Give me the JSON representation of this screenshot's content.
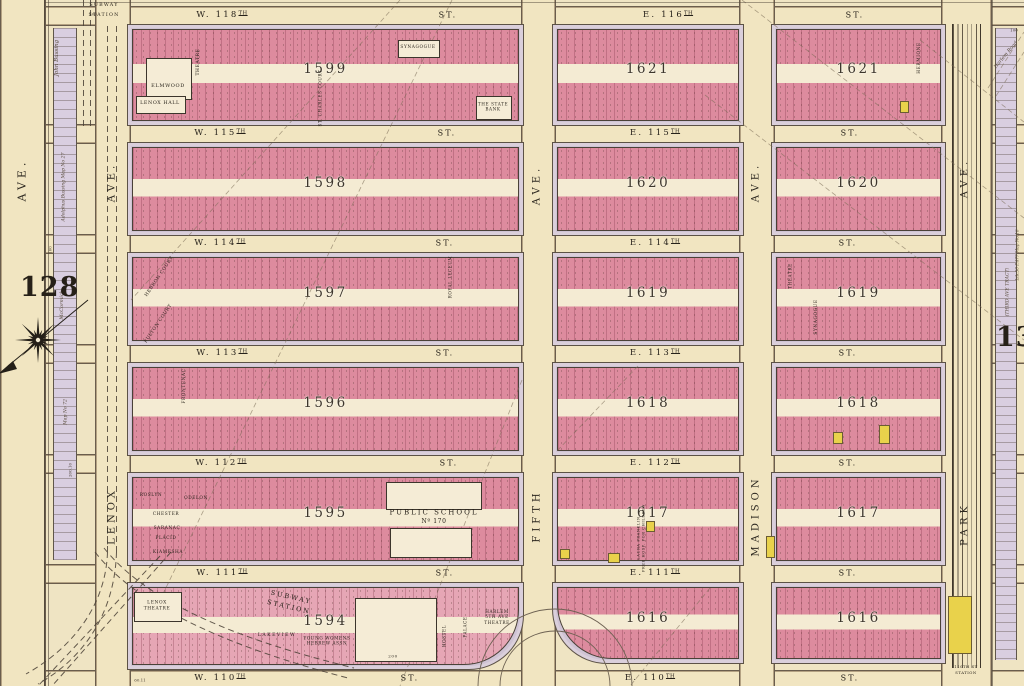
{
  "plate": {
    "left": "128",
    "right": "130"
  },
  "subway": {
    "top_line1": "SUBWAY",
    "top_line2": "STATION",
    "bottom_label": "SUBWAY\nSTATION",
    "park_station_line1": "110TH ST",
    "park_station_line2": "STATION"
  },
  "colors": {
    "paper": "#efe4c3",
    "street": "#f1e5c1",
    "block_pink": "#dd8b9e",
    "sidewalk": "#cfc3d4",
    "frame_yellow": "#e9d24b",
    "ink": "#2e2a22"
  },
  "avenues": [
    {
      "id": "west-edge-ave",
      "x": 0,
      "w": 44,
      "labels": [
        {
          "t": "AVE.",
          "cx": 22,
          "cy": 180,
          "s": 11
        }
      ]
    },
    {
      "id": "lenox-ave",
      "x": 95,
      "w": 34,
      "labels": [
        {
          "t": "AVE.",
          "cx": 112,
          "cy": 182,
          "s": 10
        },
        {
          "t": "LENOX",
          "cx": 112,
          "cy": 516,
          "s": 10
        }
      ]
    },
    {
      "id": "fifth-ave",
      "x": 521,
      "w": 33,
      "labels": [
        {
          "t": "AVE.",
          "cx": 537,
          "cy": 185,
          "s": 10
        },
        {
          "t": "FIFTH",
          "cx": 537,
          "cy": 516,
          "s": 10
        }
      ]
    },
    {
      "id": "madison-ave",
      "x": 739,
      "w": 34,
      "labels": [
        {
          "t": "AVE.",
          "cx": 756,
          "cy": 182,
          "s": 10
        },
        {
          "t": "MADISON",
          "cx": 756,
          "cy": 516,
          "s": 10
        }
      ]
    },
    {
      "id": "park-ave",
      "x": 941,
      "w": 49,
      "labels": [
        {
          "t": "AVE.",
          "cx": 965,
          "cy": 178,
          "s": 10
        },
        {
          "t": "PARK",
          "cx": 965,
          "cy": 524,
          "s": 10
        }
      ]
    }
  ],
  "streets": [
    {
      "id": "w-118th-e-116th",
      "west": "W. 118TH",
      "west_st": "ST.",
      "east": "E. 116TH",
      "east_st": "ST.",
      "y": 6,
      "h": 18,
      "wx": 222,
      "wsx": 448,
      "ex": 668,
      "esx": 855
    },
    {
      "id": "w-115th-e-115th",
      "west": "W. 115TH",
      "west_st": "ST.",
      "east": "E. 115TH",
      "east_st": "ST.",
      "y": 124,
      "h": 18,
      "wx": 220,
      "wsx": 447,
      "ex": 655,
      "esx": 850
    },
    {
      "id": "w-114th-e-114th",
      "west": "W. 114TH",
      "west_st": "ST.",
      "east": "E. 114TH",
      "east_st": "ST.",
      "y": 234,
      "h": 18,
      "wx": 220,
      "wsx": 445,
      "ex": 655,
      "esx": 848
    },
    {
      "id": "w-113th-e-113th",
      "west": "W. 113TH",
      "west_st": "ST.",
      "east": "E. 113TH",
      "east_st": "ST.",
      "y": 344,
      "h": 18,
      "wx": 222,
      "wsx": 445,
      "ex": 655,
      "esx": 848
    },
    {
      "id": "w-112th-e-112th",
      "west": "W. 112TH",
      "west_st": "ST.",
      "east": "E. 112TH",
      "east_st": "ST.",
      "y": 454,
      "h": 18,
      "wx": 221,
      "wsx": 449,
      "ex": 655,
      "esx": 848
    },
    {
      "id": "w-111th-e-111th",
      "west": "W. 111TH",
      "west_st": "ST.",
      "east": "E. 111TH",
      "east_st": "ST.",
      "y": 564,
      "h": 18,
      "wx": 222,
      "wsx": 445,
      "ex": 655,
      "esx": 848
    },
    {
      "id": "w-110th-e-110th",
      "west": "W. 110TH",
      "west_st": "ST.",
      "east": "E. 110TH",
      "east_st": "ST.",
      "y": 670,
      "h": 16,
      "wx": 220,
      "wsx": 410,
      "ex": 650,
      "esx": 850
    }
  ],
  "blocks": [
    {
      "n": "1599",
      "x": 131,
      "y": 28,
      "w": 387,
      "h": 92
    },
    {
      "n": "1621",
      "x": 556,
      "y": 28,
      "w": 182,
      "h": 92
    },
    {
      "n": "1621",
      "x": 775,
      "y": 28,
      "w": 165,
      "h": 92
    },
    {
      "n": "1598",
      "x": 131,
      "y": 146,
      "w": 387,
      "h": 84
    },
    {
      "n": "1620",
      "x": 556,
      "y": 146,
      "w": 182,
      "h": 84
    },
    {
      "n": "1620",
      "x": 775,
      "y": 146,
      "w": 165,
      "h": 84
    },
    {
      "n": "1597",
      "x": 131,
      "y": 256,
      "w": 387,
      "h": 84
    },
    {
      "n": "1619",
      "x": 556,
      "y": 256,
      "w": 182,
      "h": 84
    },
    {
      "n": "1619",
      "x": 775,
      "y": 256,
      "w": 165,
      "h": 84
    },
    {
      "n": "1596",
      "x": 131,
      "y": 366,
      "w": 387,
      "h": 84
    },
    {
      "n": "1618",
      "x": 556,
      "y": 366,
      "w": 182,
      "h": 84
    },
    {
      "n": "1618",
      "x": 775,
      "y": 366,
      "w": 165,
      "h": 84
    },
    {
      "n": "1595",
      "x": 131,
      "y": 476,
      "w": 387,
      "h": 84
    },
    {
      "n": "1617",
      "x": 556,
      "y": 476,
      "w": 182,
      "h": 84
    },
    {
      "n": "1617",
      "x": 775,
      "y": 476,
      "w": 165,
      "h": 84
    },
    {
      "n": "1594",
      "x": 131,
      "y": 586,
      "w": 387,
      "h": 78,
      "light": true,
      "corner": "br"
    },
    {
      "n": "1616",
      "x": 556,
      "y": 586,
      "w": 182,
      "h": 72,
      "corner": "bl"
    },
    {
      "n": "1616",
      "x": 775,
      "y": 586,
      "w": 165,
      "h": 72
    }
  ],
  "features": [
    {
      "id": "elmwood-building",
      "rect": [
        146,
        58,
        44,
        40
      ]
    },
    {
      "id": "elmwood",
      "t": "ELMWOOD",
      "cx": 168,
      "cy": 86,
      "s": 5
    },
    {
      "id": "lenox-hall-building",
      "rect": [
        136,
        96,
        48,
        16
      ]
    },
    {
      "id": "lenox-hall",
      "t": "LENOX HALL",
      "cx": 160,
      "cy": 104,
      "s": 4.8
    },
    {
      "id": "theatre-1599",
      "t": "THEATRE",
      "cx": 199,
      "cy": 62,
      "s": 4.5,
      "rot": -90
    },
    {
      "id": "synagogue-1599-building",
      "rect": [
        398,
        40,
        40,
        16
      ]
    },
    {
      "id": "synagogue-1599",
      "t": "SYNAGOGUE",
      "cx": 418,
      "cy": 48,
      "s": 4.3
    },
    {
      "id": "state-bank-building",
      "rect": [
        476,
        96,
        34,
        22
      ]
    },
    {
      "id": "state-bank",
      "t": "THE STATE\nBANK",
      "cx": 493,
      "cy": 107,
      "s": 4.2
    },
    {
      "id": "st-charles-court",
      "t": "ST. CHARLES COURT",
      "cx": 320,
      "cy": 98,
      "s": 4.2,
      "rot": -90
    },
    {
      "id": "hermione",
      "t": "HERMIONE",
      "cx": 920,
      "cy": 58,
      "s": 4.3,
      "rot": -90
    },
    {
      "id": "hebron-court",
      "t": "HEBRON COURT",
      "cx": 160,
      "cy": 277,
      "s": 4.5,
      "rot": -56
    },
    {
      "id": "fulton-court",
      "t": "FULTON COURT",
      "cx": 159,
      "cy": 324,
      "s": 4.5,
      "rot": -56
    },
    {
      "id": "royal-lyceum",
      "t": "ROYAL LYCEUM",
      "cx": 450,
      "cy": 277,
      "s": 4.2,
      "rot": -90
    },
    {
      "id": "frontenac",
      "t": "FRONTENAC",
      "cx": 185,
      "cy": 386,
      "s": 4.3,
      "rot": -90
    },
    {
      "id": "synagogue-1619",
      "t": "SYNAGOGUE",
      "cx": 817,
      "cy": 317,
      "s": 4.3,
      "rot": -90
    },
    {
      "id": "theatre-1619",
      "t": "THEATRE",
      "cx": 790,
      "cy": 276,
      "s": 4.2,
      "rot": -90
    },
    {
      "id": "roslyn",
      "t": "ROSLYN",
      "cx": 151,
      "cy": 496,
      "s": 4.3
    },
    {
      "id": "odelon",
      "t": "ODELON",
      "cx": 196,
      "cy": 499,
      "s": 4.3
    },
    {
      "id": "chester",
      "t": "CHESTER",
      "cx": 166,
      "cy": 515,
      "s": 4.3
    },
    {
      "id": "saranac",
      "t": "SARANAC",
      "cx": 167,
      "cy": 529,
      "s": 4.3
    },
    {
      "id": "placid",
      "t": "PLACID",
      "cx": 166,
      "cy": 539,
      "s": 4.3
    },
    {
      "id": "kiamesha",
      "t": "KIAMESHA",
      "cx": 168,
      "cy": 553,
      "s": 4.3
    },
    {
      "id": "school-yard-north",
      "rect": [
        386,
        482,
        94,
        26
      ]
    },
    {
      "id": "school-yard-south",
      "rect": [
        390,
        528,
        80,
        28
      ]
    },
    {
      "id": "public-school",
      "t": "PUBLIC SCHOOL",
      "cx": 434,
      "cy": 513,
      "s": 7,
      "ls": 2
    },
    {
      "id": "public-school-no",
      "t": "Nº 170",
      "cx": 434,
      "cy": 522,
      "s": 6
    },
    {
      "id": "laura-franklin",
      "t": "LAURA FRANKLIN\nFREE HOSP. FOR CHILDREN",
      "cx": 641,
      "cy": 538,
      "s": 3.6,
      "rot": -90
    },
    {
      "id": "lenox-theatre-building",
      "rect": [
        134,
        592,
        46,
        28
      ]
    },
    {
      "id": "lenox-theatre",
      "t": "LENOX\nTHEATRE",
      "cx": 157,
      "cy": 606,
      "s": 4.4
    },
    {
      "id": "lakeview",
      "t": "LAKEVIEW",
      "cx": 277,
      "cy": 636,
      "s": 4.6,
      "ls": 1.5
    },
    {
      "id": "ywha",
      "t": "YOUNG WOMENS\nHEBREW ASSN",
      "cx": 327,
      "cy": 641,
      "s": 4.2
    },
    {
      "id": "vacant-lot-1594",
      "rect": [
        355,
        598,
        80,
        62
      ]
    },
    {
      "id": "dim-200",
      "t": "200",
      "cx": 393,
      "cy": 656,
      "s": 4
    },
    {
      "id": "hostel",
      "t": "HOSTEL",
      "cx": 444,
      "cy": 636,
      "s": 4.2,
      "rot": -90
    },
    {
      "id": "palace",
      "t": "PALACE",
      "cx": 465,
      "cy": 627,
      "s": 4.2,
      "rot": -90
    },
    {
      "id": "harlem-5th-ave-theatre",
      "t": "HARLEM\n5TH AVE\nTHEATRE",
      "cx": 497,
      "cy": 617,
      "s": 4.2
    }
  ],
  "yellow_buildings": [
    [
      879,
      425,
      9,
      17
    ],
    [
      833,
      432,
      8,
      10
    ],
    [
      766,
      536,
      7,
      20
    ],
    [
      646,
      521,
      7,
      9
    ],
    [
      608,
      553,
      10,
      8
    ],
    [
      560,
      549,
      8,
      8
    ],
    [
      900,
      101,
      7,
      10
    ],
    [
      948,
      596,
      22,
      56
    ]
  ],
  "margin_notes": [
    {
      "id": "john-bussing",
      "t": "John Bussing",
      "cx": 57,
      "cy": 58,
      "s": 5.5
    },
    {
      "id": "adolphus-bussing",
      "t": "Adolphus Bussing Map No 27",
      "cx": 64,
      "cy": 187,
      "s": 4.6
    },
    {
      "id": "mccormick",
      "t": "McCormick",
      "cx": 62,
      "cy": 305,
      "s": 5
    },
    {
      "id": "map-no-72",
      "t": "Map No 72",
      "cx": 66,
      "cy": 412,
      "s": 4.6
    },
    {
      "id": "third-ave-tract",
      "t": "(THIRD AVE TRACT)",
      "cx": 1008,
      "cy": 292,
      "s": 4.6
    },
    {
      "id": "lib-note",
      "t": "Lib.50 P.477 Map No.16",
      "cx": 1017,
      "cy": 255,
      "s": 4.2
    },
    {
      "id": "harlem-road",
      "t": "Harlem Road",
      "cx": 1006,
      "cy": 55,
      "s": 5,
      "rot": -50
    }
  ],
  "dimensions": [
    {
      "t": "100",
      "cx": 93,
      "cy": 14,
      "s": 4
    },
    {
      "t": "100",
      "cx": 1014,
      "cy": 30,
      "s": 4
    },
    {
      "t": "60.11",
      "cx": 140,
      "cy": 680,
      "s": 4
    },
    {
      "t": "100",
      "cx": 50,
      "cy": 250,
      "s": 4,
      "rot": -90
    },
    {
      "t": "200.10",
      "cx": 70,
      "cy": 470,
      "s": 4,
      "rot": -90
    }
  ]
}
